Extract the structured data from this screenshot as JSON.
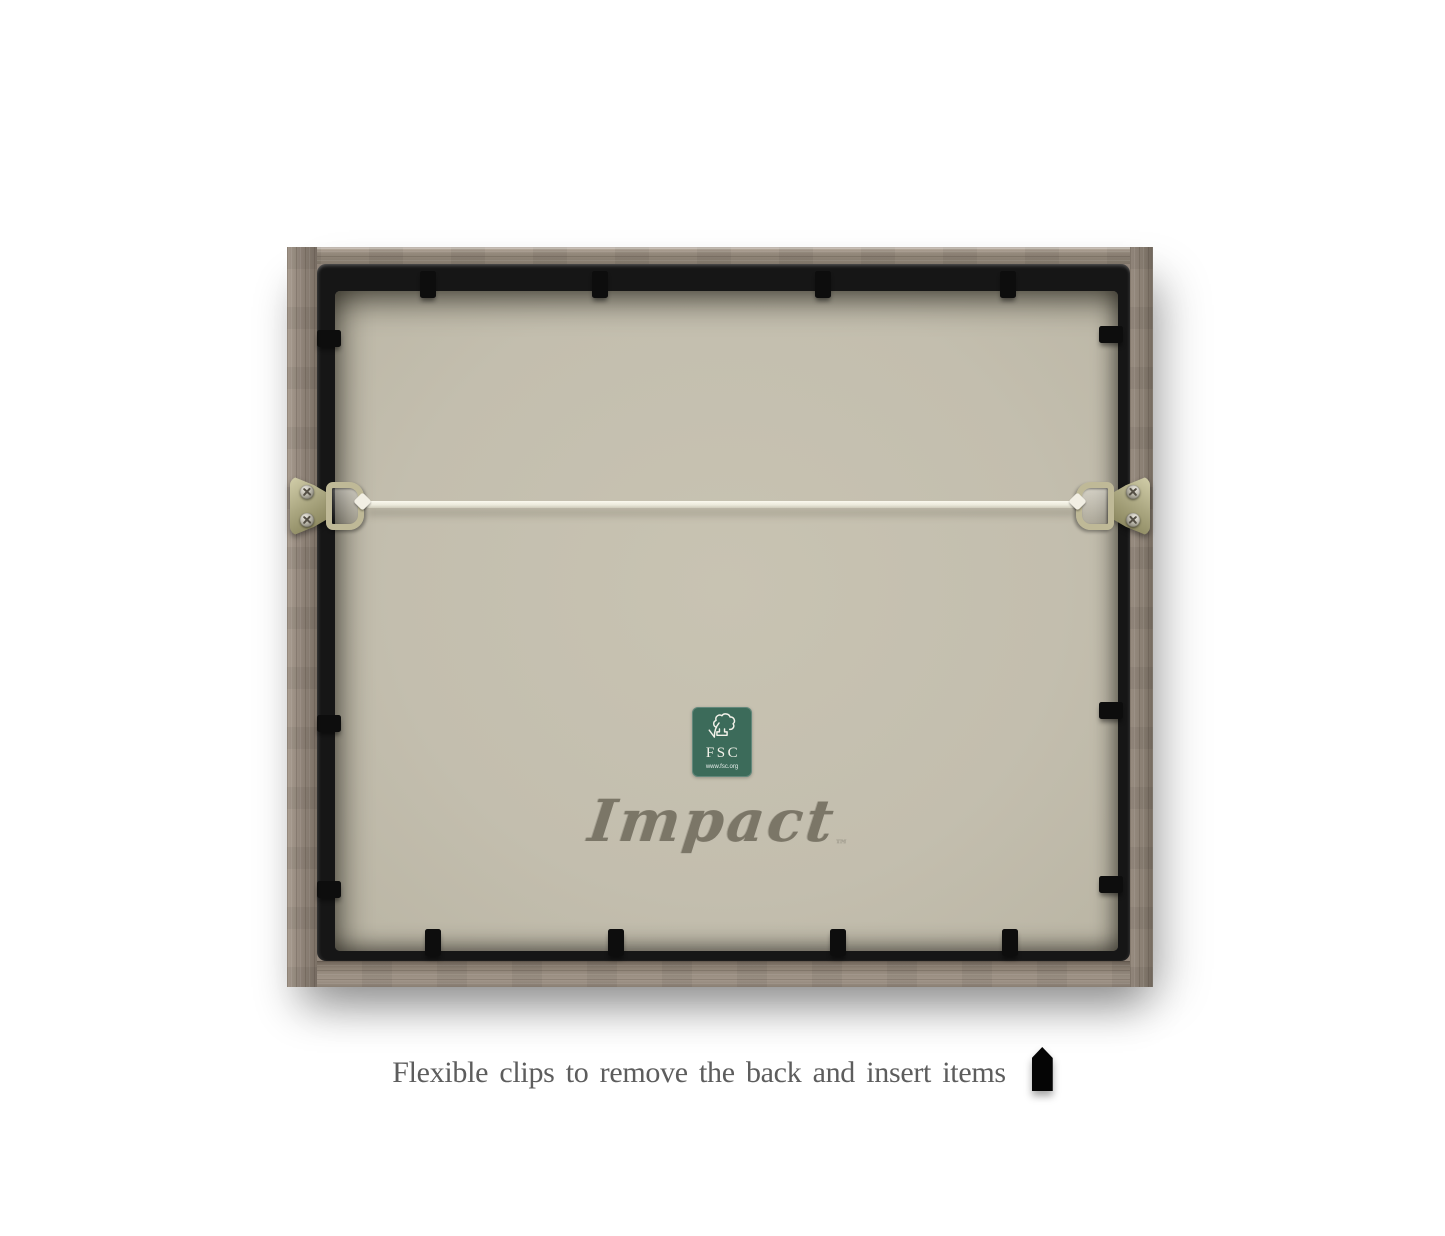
{
  "page": {
    "background_color": "#ffffff"
  },
  "frame_back": {
    "wood_color": "#91857a",
    "panel_color": "#161616",
    "backing_color": "#c3beae",
    "clip_color": "#0d0d0d",
    "clip_counts": {
      "top": 4,
      "bottom": 4,
      "left": 3,
      "right": 3
    },
    "hardware": {
      "left_hanger_icon": "d-ring-hanger-icon",
      "right_hanger_icon": "d-ring-hanger-icon",
      "wire_icon": "hanging-wire",
      "wire_color": "#efede0",
      "plate_color": "#aaa680"
    }
  },
  "fsc_label": {
    "background_color": "#3c6b5a",
    "tree_icon": "fsc-tree-checkmark-icon",
    "acronym": "FSC",
    "url": "www.fsc.org"
  },
  "brand": {
    "name": "Impact",
    "trademark": "™",
    "color": "#7b7667"
  },
  "caption": {
    "text": "Flexible clips to remove the back and insert items",
    "icon": "flexible-clip-icon",
    "color": "#5d5d5d"
  }
}
